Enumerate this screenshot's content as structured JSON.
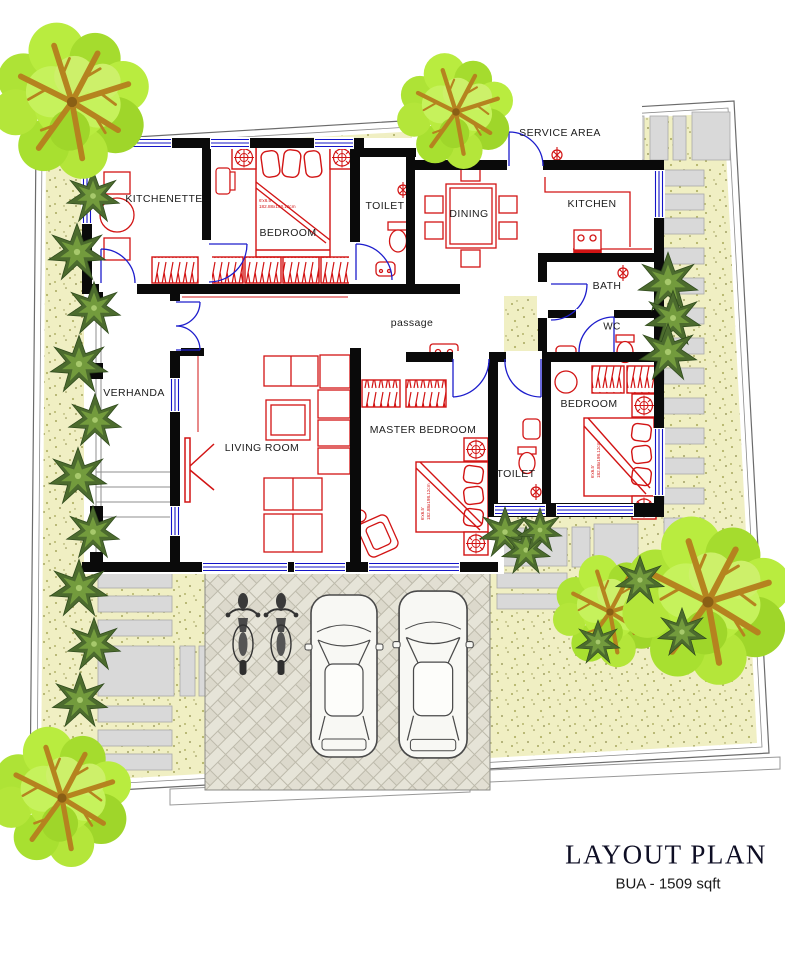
{
  "document": {
    "title": "LAYOUT PLAN",
    "subtitle": "BUA - 1509 sqft"
  },
  "rooms": {
    "kitchenette": "KITCHENETTE",
    "bedroom_top": "BEDROOM",
    "toilet_top": "TOILET",
    "dining": "DINING",
    "service_area": "SERVICE AREA",
    "kitchen": "KITCHEN",
    "bath": "BATH",
    "wc": "WC",
    "passage": "passage",
    "verhanda": "VERHANDA",
    "living_room": "LIVING ROOM",
    "master_bedroom": "MASTER BEDROOM",
    "bedroom_right": "BEDROOM",
    "toilet_bottom": "TOILET"
  },
  "annotations": {
    "bed_size_ft": "6'x6.5'",
    "bed_size_cm": "182.88x198.12cm"
  },
  "colors": {
    "wall": "#0a0a0a",
    "furniture_red": "#d21414",
    "door_window_blue": "#1414c8",
    "lawn": "#f0efc3",
    "paving_stone": "#d9d9d9",
    "tree_foliage": "#b4e637",
    "tree_branch": "#b5831f"
  }
}
